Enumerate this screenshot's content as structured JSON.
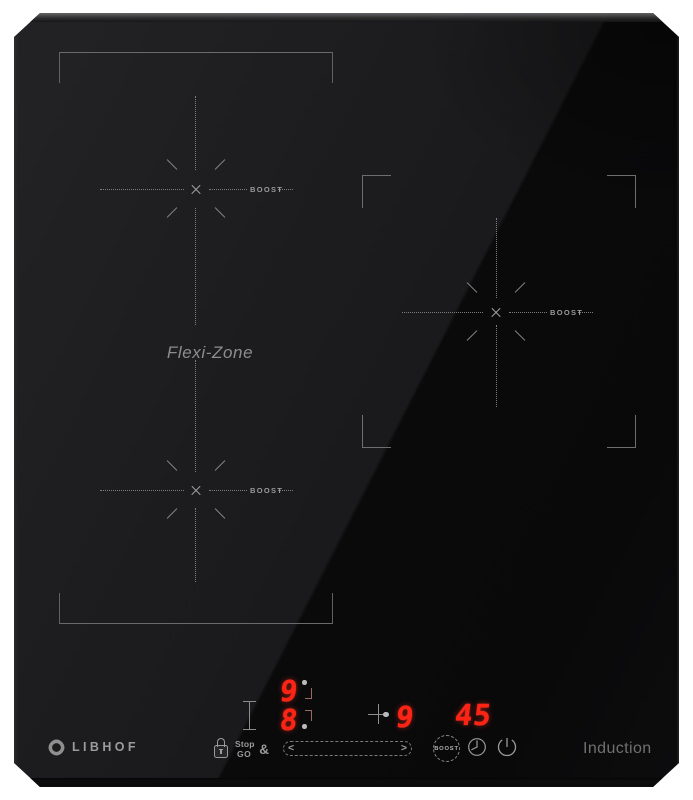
{
  "brand": {
    "name": "LIBHOF",
    "logo_icon": "libhof-pinwheel-icon",
    "type_label": "Induction"
  },
  "surface": {
    "flexi_zone": {
      "label": "Flexi-Zone",
      "rear_boost_label": "BOOST",
      "front_boost_label": "BOOST"
    },
    "right_zone": {
      "boost_label": "BOOST"
    }
  },
  "display": {
    "rear_left_power": "9",
    "front_left_power": "8",
    "right_power": "9",
    "timer": "45"
  },
  "controls": {
    "lock_icon": "key-lock",
    "pause_key": {
      "line1": "Stop",
      "line2": "GO",
      "amp": "&"
    },
    "slider": {
      "left_arrow": "<",
      "right_arrow": ">"
    },
    "boost_key_label": "BOOST",
    "timer_icon": "clock",
    "power_icon": "power"
  },
  "colors": {
    "background": "#ffffff",
    "glass_light": "#1c1c1e",
    "glass_dark": "#0a0a0b",
    "zone_marking": "#7c7c7c",
    "digit_red": "#ff2315",
    "label_gray": "#9a9a9a"
  }
}
